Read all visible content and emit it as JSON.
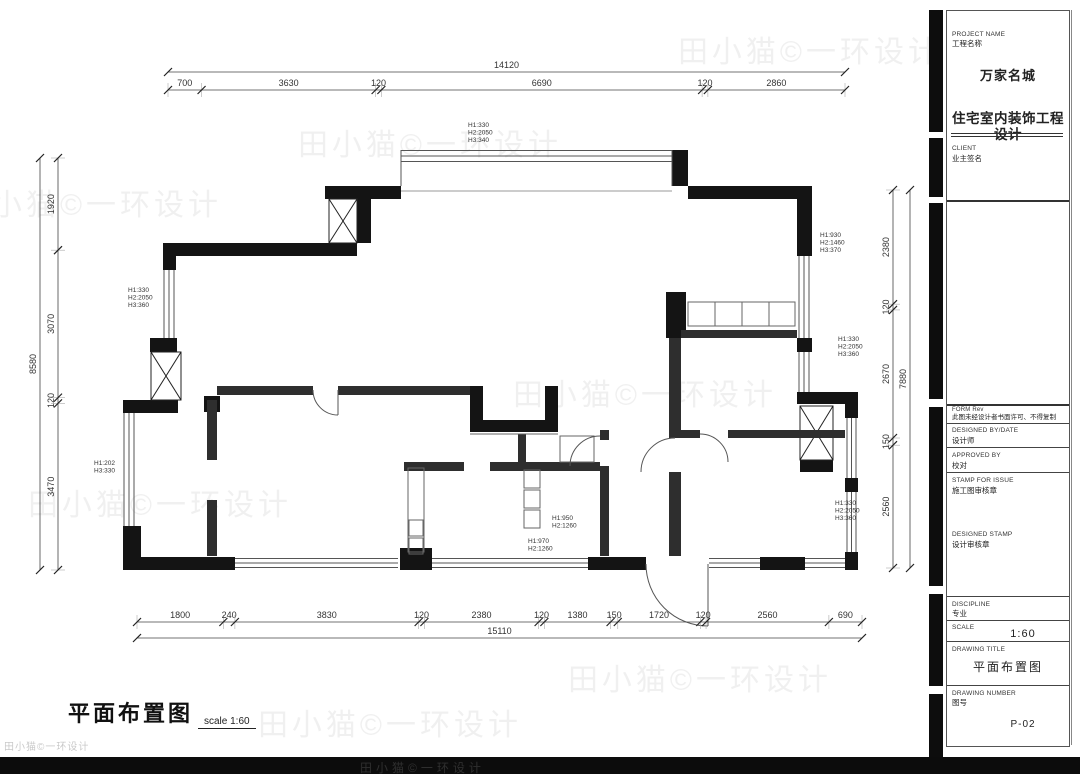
{
  "sheet": {
    "watermark": "田小猫©一环设计",
    "footer_title": "平面布置图",
    "footer_scale": "scale 1:60"
  },
  "title_block": {
    "project_name_label": "PROJECT NAME",
    "project_name_cn": "工程名称",
    "project_name": "万家名城",
    "project_type": "住宅室内装饰工程设计",
    "client_label": "CLIENT",
    "client_cn": "业主签名",
    "form_label": "FORM Rev",
    "form_note": "此图未经设计者书面许可、不得复制",
    "designed_by_label": "DESIGNED BY/DATE",
    "designed_by_cn": "设计师",
    "approved_by_label": "APPROVED BY",
    "approved_by_cn": "校对",
    "stamp_label": "STAMP FOR ISSUE",
    "stamp_cn": "施工图审核章",
    "designed_stamp_label": "DESIGNED STAMP",
    "designed_stamp_cn": "设计审核章",
    "discipline_label": "DISCIPLINE",
    "discipline_cn": "专业",
    "scale_label": "SCALE",
    "scale_value": "1:60",
    "drawing_title_label": "DRAWING TITLE",
    "drawing_title": "平面布置图",
    "drawing_number_label": "DRAWING NUMBER",
    "drawing_number_cn": "图号",
    "drawing_number": "P-02"
  },
  "dimensions": {
    "top": {
      "overall": "14120",
      "segments": [
        "700",
        "3630",
        "120",
        "6690",
        "120",
        "2860"
      ]
    },
    "bottom": {
      "overall": "15110",
      "segments": [
        "1800",
        "240",
        "3830",
        "120",
        "2380",
        "120",
        "1380",
        "150",
        "1720",
        "120",
        "2560",
        "690"
      ]
    },
    "left": {
      "overall": "8580",
      "segments": [
        "1920",
        "3070",
        "120",
        "3470"
      ]
    },
    "right": {
      "overall": "7880",
      "segments": [
        "2380",
        "120",
        "2670",
        "150",
        "2560"
      ]
    }
  },
  "h_labels": [
    {
      "x": 468,
      "y": 127,
      "lines": [
        "H1:330",
        "H2:2050",
        "H3:340"
      ]
    },
    {
      "x": 128,
      "y": 292,
      "lines": [
        "H1:330",
        "H2:2050",
        "H3:360"
      ]
    },
    {
      "x": 820,
      "y": 237,
      "lines": [
        "H1:930",
        "H2:1460",
        "H3:370"
      ]
    },
    {
      "x": 838,
      "y": 341,
      "lines": [
        "H1:330",
        "H2:2050",
        "H3:360"
      ]
    },
    {
      "x": 94,
      "y": 465,
      "lines": [
        "H1:202",
        "H3:330"
      ]
    },
    {
      "x": 835,
      "y": 505,
      "lines": [
        "H1:330",
        "H2:2050",
        "H3:360"
      ]
    },
    {
      "x": 552,
      "y": 520,
      "lines": [
        "H1:950",
        "H2:1260"
      ]
    },
    {
      "x": 528,
      "y": 543,
      "lines": [
        "H1:970",
        "H2:1260"
      ]
    }
  ]
}
